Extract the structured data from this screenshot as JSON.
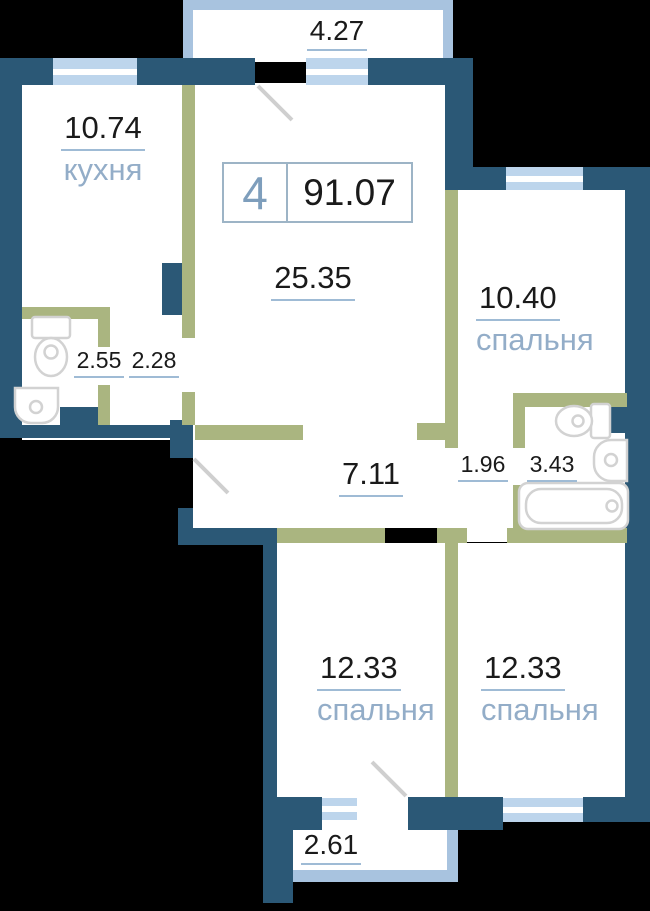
{
  "palette": {
    "wall": "#2B5876",
    "partition": "#AAB580",
    "window": "#BDD5EC",
    "balcony": "#A8C3DF",
    "fixture": "#D2D2D2",
    "door": "#CFCFCF",
    "number": "#1A1A1A",
    "room-name": "#93ADC8",
    "underline": "#9FBBD5",
    "badge-border": "#9DB4C6",
    "badge-number": "#7E9EBC",
    "bg": "#000000"
  },
  "badge": {
    "rooms": "4",
    "area": "91.07"
  },
  "rooms": {
    "kitchen": {
      "area": "10.74",
      "name": "кухня"
    },
    "living": {
      "area": "25.35"
    },
    "bedroom_top": {
      "area": "10.40",
      "name": "спальня"
    },
    "wc": {
      "area": "2.55"
    },
    "nook": {
      "area": "2.28"
    },
    "hall": {
      "area": "7.11"
    },
    "lobby": {
      "area": "1.96"
    },
    "bathroom": {
      "area": "3.43"
    },
    "bedroom_bottom_left": {
      "area": "12.33",
      "name": "спальня"
    },
    "bedroom_bottom_right": {
      "area": "12.33",
      "name": "спальня"
    },
    "balcony_top": {
      "area": "4.27"
    },
    "balcony_bottom": {
      "area": "2.61"
    }
  }
}
